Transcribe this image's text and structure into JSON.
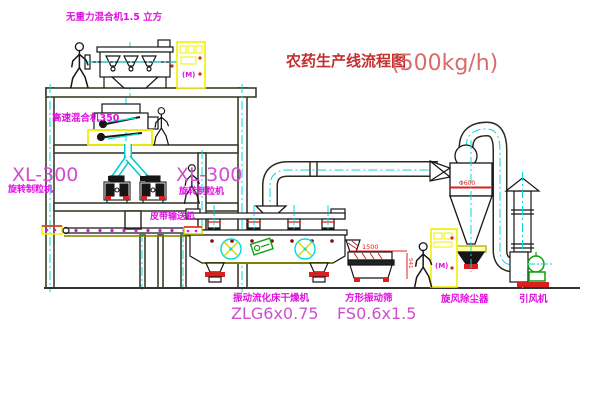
{
  "title": {
    "name": "农药生产线流程图",
    "capacity": "(500kg/h)"
  },
  "equipment": {
    "gravity_mixer": {
      "label": "无重力混合机1.5 立方"
    },
    "high_speed_mixer": {
      "label": "高速混合机350"
    },
    "granulator_left": {
      "model": "XL-300",
      "name": "旋转制粒机"
    },
    "granulator_right": {
      "model": "XL-300",
      "name": "旋转制粒机"
    },
    "belt_conveyor": {
      "label": "皮带输送机"
    },
    "fluid_bed_dryer": {
      "name": "振动流化床干燥机",
      "model": "ZLG6x0.75"
    },
    "vibrating_screen": {
      "name": "方形振动筛",
      "model": "FS0.6x1.5",
      "dim_width": "1500",
      "dim_height": "541"
    },
    "cyclone": {
      "name": "旋风除尘器",
      "dim": "Φ600"
    },
    "fan": {
      "name": "引风机"
    },
    "control_cabinet_1": {
      "text": "(M)"
    },
    "control_cabinet_2": {
      "text": "(M)"
    }
  },
  "colors": {
    "label_magenta": "#e010e0",
    "label_pink": "#cf4fcf",
    "title_red": "#c23030",
    "capacity_red": "#d96b6b",
    "dimension_red": "#d92020",
    "structure": "#3c3c2c",
    "equipment_black": "#161616",
    "centerline_cyan": "#00dcdc",
    "highlight_yellow": "#f0f000",
    "machine_green": "#0f9f0f"
  }
}
